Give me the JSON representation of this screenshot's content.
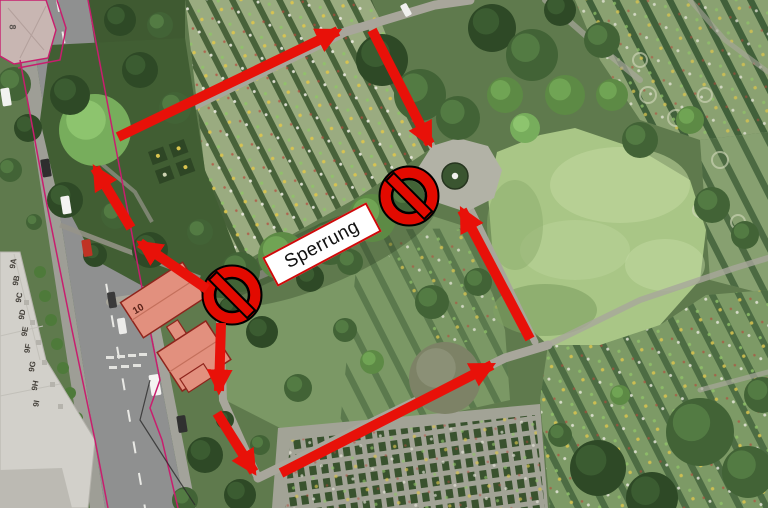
{
  "map": {
    "closure_label": "Sperrung",
    "chapel_number": "10",
    "corner_building_number": "8",
    "street_unit_labels": [
      {
        "text": "9A",
        "x": 8,
        "y": 259
      },
      {
        "text": "9B",
        "x": 11,
        "y": 276
      },
      {
        "text": "9C",
        "x": 14,
        "y": 293
      },
      {
        "text": "9D",
        "x": 17,
        "y": 310
      },
      {
        "text": "9E",
        "x": 20,
        "y": 327
      },
      {
        "text": "9F",
        "x": 23,
        "y": 344
      },
      {
        "text": "9G",
        "x": 27,
        "y": 362
      },
      {
        "text": "9H",
        "x": 30,
        "y": 381
      },
      {
        "text": "9I",
        "x": 33,
        "y": 399
      }
    ],
    "annotations": {
      "arrows": [
        {
          "name": "detour-arrow-nw-from-chapel",
          "from": [
            207,
            289
          ],
          "to": [
            140,
            243
          ]
        },
        {
          "name": "detour-arrow-north-along-west-path",
          "from": [
            131,
            228
          ],
          "to": [
            95,
            168
          ]
        },
        {
          "name": "detour-arrow-northeast-top-path",
          "from": [
            118,
            137
          ],
          "to": [
            338,
            31
          ]
        },
        {
          "name": "detour-arrow-south-to-plaza",
          "from": [
            372,
            30
          ],
          "to": [
            430,
            144
          ]
        },
        {
          "name": "detour-arrow-south-from-chapel",
          "from": [
            221,
            323
          ],
          "to": [
            219,
            391
          ]
        },
        {
          "name": "detour-arrow-southeast-to-bottom-path",
          "from": [
            217,
            413
          ],
          "to": [
            254,
            472
          ]
        },
        {
          "name": "detour-arrow-northeast-bottom-path",
          "from": [
            281,
            473
          ],
          "to": [
            492,
            365
          ]
        },
        {
          "name": "detour-arrow-north-to-plaza",
          "from": [
            530,
            339
          ],
          "to": [
            462,
            210
          ]
        }
      ],
      "no_entry_signs": [
        {
          "name": "no-entry-sign-west",
          "x": 232,
          "y": 295
        },
        {
          "name": "no-entry-sign-east",
          "x": 409,
          "y": 196
        }
      ],
      "closure_box": {
        "x": 322,
        "y": 244,
        "width": 118,
        "height": 33,
        "rotation_deg": -28
      }
    },
    "colors": {
      "arrow_red": "#e81109",
      "sign_red": "#e20a00",
      "sign_outline": "#000000",
      "closure_box_bg": "#ffffff",
      "closure_box_border": "#cf0a0a",
      "cadastral_magenta": "#c81e6e",
      "building_roof_salmon": "#e2907e"
    }
  }
}
